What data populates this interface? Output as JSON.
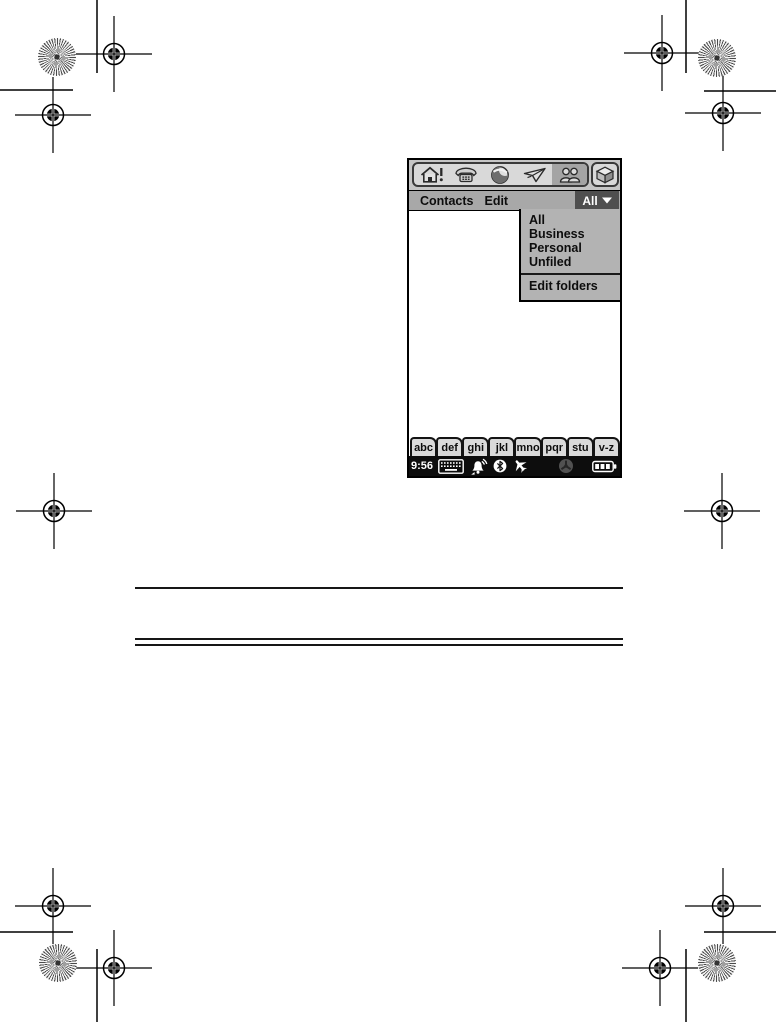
{
  "page": {
    "kind": "printed manual page with device screenshot",
    "background": "#ffffff"
  },
  "colors": {
    "chrome_gray": "#c6c6c6",
    "menu_bar_gray": "#a8a8a8",
    "dropdown_gray": "#b3b3b3",
    "selected_dark": "#4f4f4f",
    "status_bar_bg": "#0d0d0d"
  },
  "device": {
    "app_bar": {
      "icons": [
        "home-alert",
        "phone",
        "web",
        "messaging",
        "contacts",
        "applications"
      ],
      "selected_icon": "contacts"
    },
    "menu_bar": {
      "menus": [
        "Contacts",
        "Edit"
      ],
      "category_label": "All"
    },
    "dropdown": {
      "items": [
        "All",
        "Business",
        "Personal",
        "Unfiled"
      ],
      "footer": "Edit folders"
    },
    "alpha_tabs": [
      "abc",
      "def",
      "ghi",
      "jkl",
      "mno",
      "pqr",
      "stu",
      "v-z"
    ],
    "status_bar": {
      "time": "9:56",
      "icons": [
        "keyboard",
        "alarm",
        "bluetooth",
        "flight-mode",
        "sync",
        "battery"
      ]
    }
  }
}
